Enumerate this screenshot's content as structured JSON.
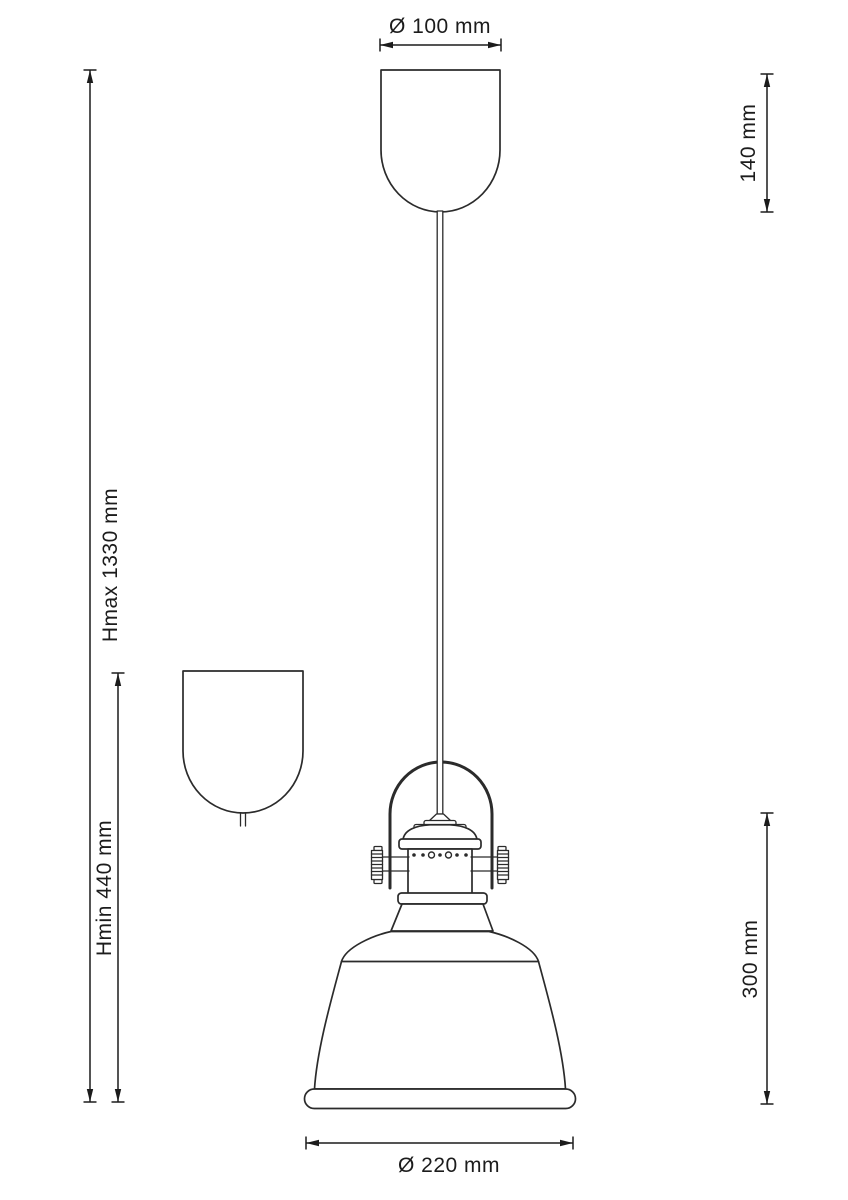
{
  "diagram": {
    "type": "technical-dimension-drawing",
    "subject": "pendant lamp with ceiling canopy, suspension cord, yoke handle and bell shade",
    "colors": {
      "background": "#ffffff",
      "line": "#2b2b2b",
      "text": "#1c1c1c"
    },
    "labels": {
      "canopy_diameter": "Ø 100 mm",
      "canopy_height": "140 mm",
      "max_height": "Hmax 1330 mm",
      "min_height": "Hmin 440 mm",
      "shade_height": "300 mm",
      "shade_diameter": "Ø 220 mm"
    }
  }
}
